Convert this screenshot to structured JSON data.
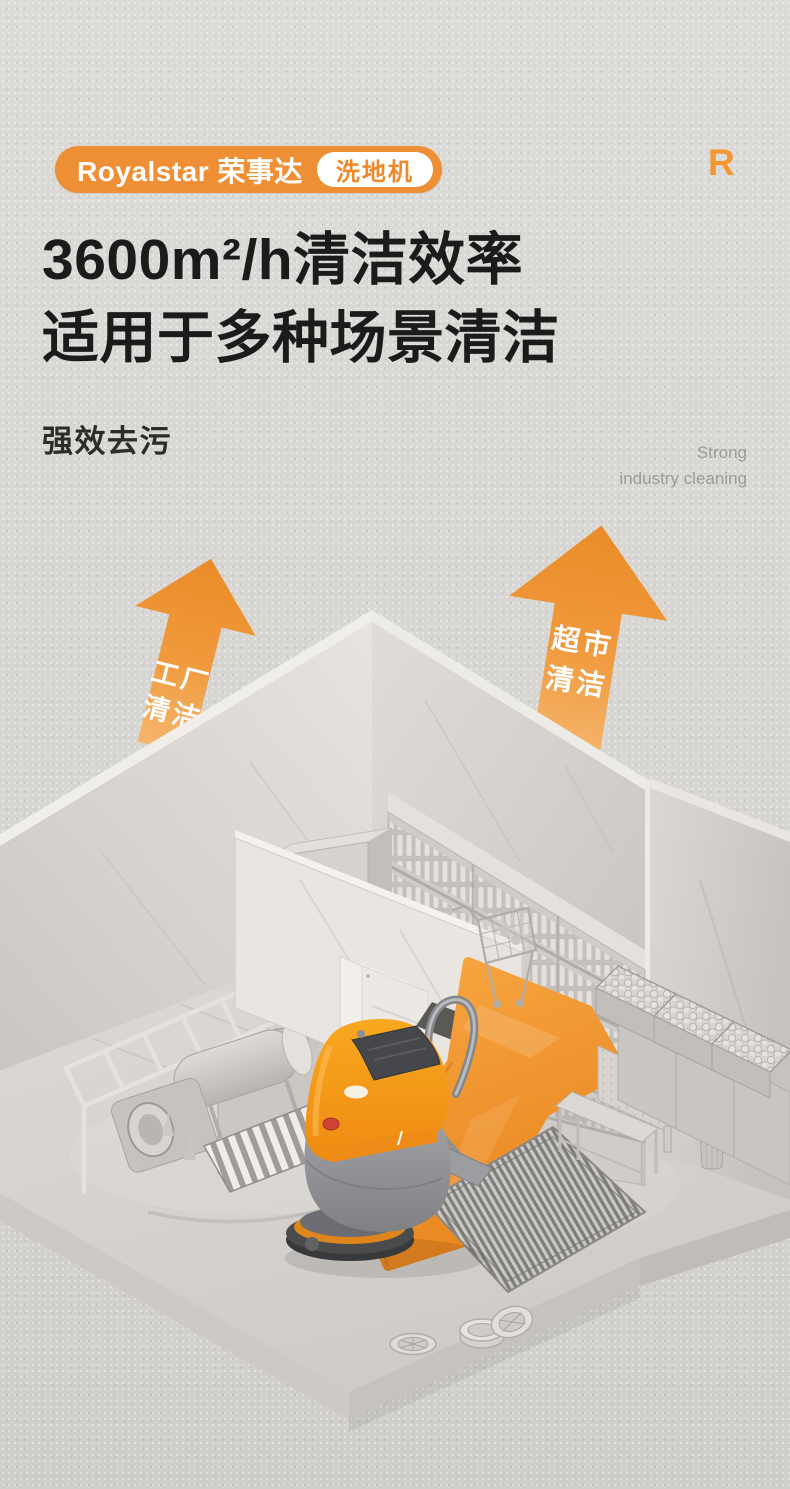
{
  "brand": {
    "logo_text": "Royalstar 荣事达",
    "category_tag": "洗地机",
    "watermark_letter": "R"
  },
  "headline": {
    "line1": "3600m²/h清洁效率",
    "line2": "适用于多种场景清洁"
  },
  "tagline": {
    "cn": "强效去污",
    "en_line1": "Strong",
    "en_line2": "industry cleaning"
  },
  "scene_labels": {
    "factory_line1": "工厂",
    "factory_line2": "清洁",
    "market_line1": "超市",
    "market_line2": "清洁"
  },
  "colors": {
    "brand_orange": "#ef8f35",
    "arrow_orange_top": "#ea8b28",
    "arrow_orange_bottom": "#f7b264",
    "floor_path_orange": "#f0932f",
    "headline_text": "#1b1b1b",
    "muted_text": "#9c9a96",
    "background": "#d8d6d2",
    "machine_orange": "#f49a1c",
    "machine_gray": "#94969a"
  }
}
